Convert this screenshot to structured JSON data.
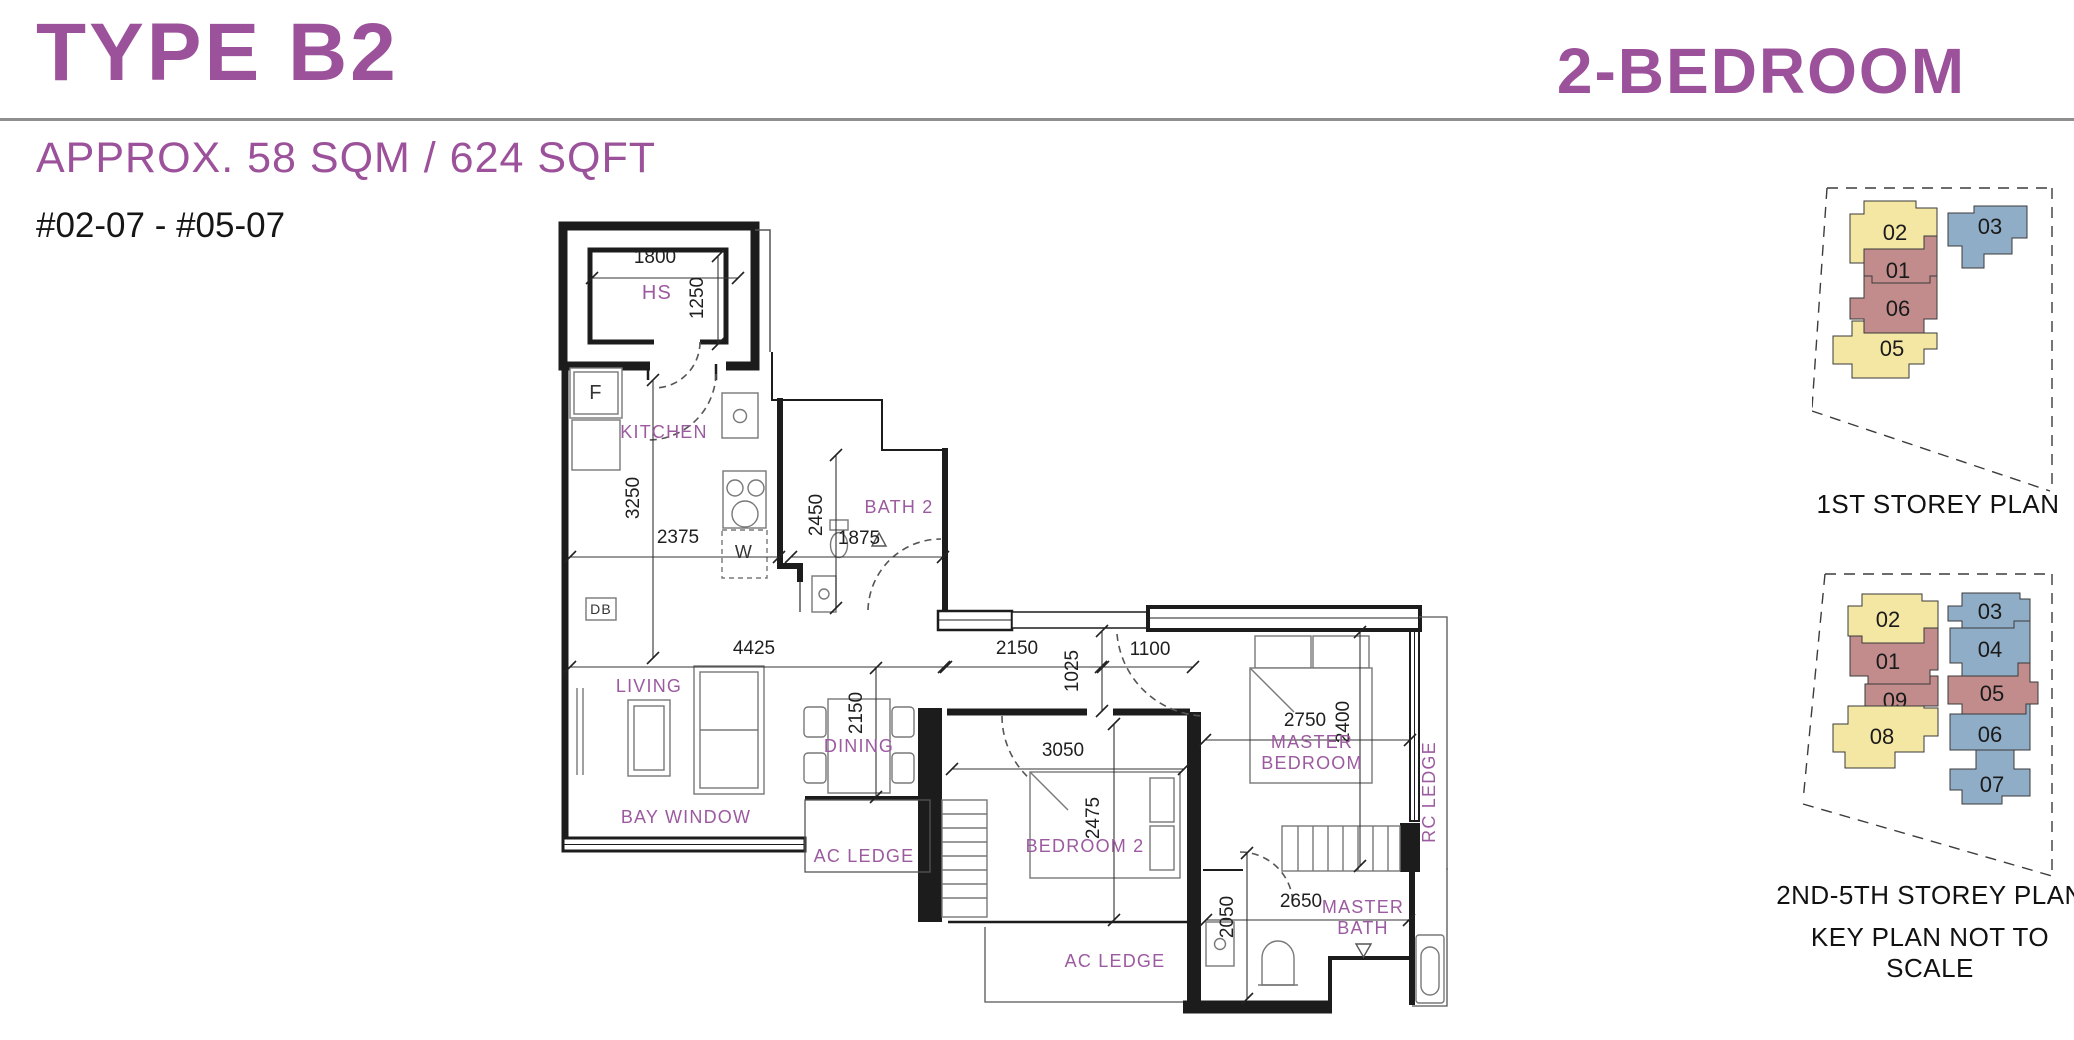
{
  "header": {
    "title": "TYPE B2",
    "category": "2-BEDROOM",
    "area": "APPROX. 58 SQM / 624 SQFT",
    "units": "#02-07 - #05-07"
  },
  "colors": {
    "accent": "#9C519B",
    "room_label": "#9C5AA0",
    "unit_yellow": "#F4E7A4",
    "unit_red": "#C28C8C",
    "unit_blue": "#90ADC7",
    "wall": "#1C1C1C"
  },
  "floor_plan": {
    "rooms": {
      "hs": "HS",
      "fridge": "F",
      "washer": "W",
      "db": "DB",
      "kitchen": "KITCHEN",
      "bath2": "BATH 2",
      "living": "LIVING",
      "dining": "DINING",
      "bay_window": "BAY WINDOW",
      "ac_ledge_side": "AC LEDGE",
      "ac_ledge_bottom": "AC LEDGE",
      "bedroom2": "BEDROOM 2",
      "master_bedroom": "MASTER BEDROOM",
      "master_bath": "MASTER BATH",
      "rc_ledge": "RC LEDGE"
    },
    "dimensions_mm": {
      "hs_width": "1800",
      "hs_depth": "1250",
      "kitchen_run": "3250",
      "kitchen_width": "2375",
      "bath2_depth": "2450",
      "bath2_width": "1875",
      "living_width": "4425",
      "hall_width": "2150",
      "master_door": "1100",
      "hall_depth": "1025",
      "dining_depth": "2150",
      "master_width": "2750",
      "master_depth": "2400",
      "bedroom2_width": "3050",
      "bedroom2_depth": "2475",
      "master_bath_depth": "2050",
      "master_bath_width": "2650"
    }
  },
  "key_plans": [
    {
      "title": "1ST STOREY PLAN",
      "units": [
        {
          "label": "02",
          "color": "yellow"
        },
        {
          "label": "01",
          "color": "red"
        },
        {
          "label": "06",
          "color": "red"
        },
        {
          "label": "05",
          "color": "yellow"
        },
        {
          "label": "03",
          "color": "blue"
        }
      ]
    },
    {
      "title": "2ND-5TH STOREY PLAN",
      "units": [
        {
          "label": "02",
          "color": "yellow"
        },
        {
          "label": "01",
          "color": "red"
        },
        {
          "label": "09",
          "color": "red"
        },
        {
          "label": "08",
          "color": "yellow"
        },
        {
          "label": "03",
          "color": "blue"
        },
        {
          "label": "04",
          "color": "blue"
        },
        {
          "label": "05",
          "color": "red"
        },
        {
          "label": "06",
          "color": "blue"
        },
        {
          "label": "07",
          "color": "blue"
        }
      ]
    }
  ],
  "key_plan_note": "KEY PLAN NOT TO SCALE"
}
